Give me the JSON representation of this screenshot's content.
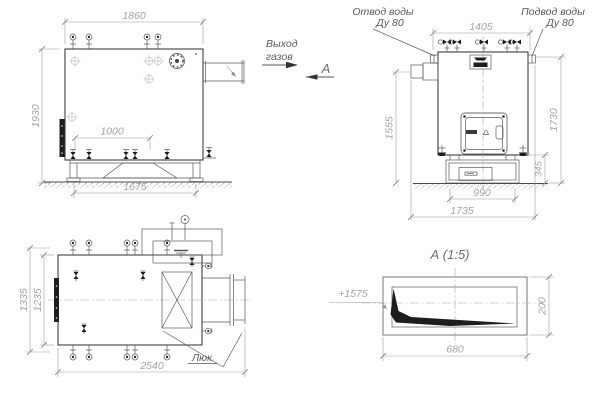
{
  "drawing_type": "boiler-assembly-drawing",
  "colors": {
    "background": "#ffffff",
    "object_line": "#3e3e3e",
    "thin_line": "#5a5a5a",
    "dimension_line": "#9c9c9c",
    "dimension_text": "#a4a4a4",
    "label_text": "#595959",
    "solid_fill": "#1d1d1d"
  },
  "annotations": {
    "gas_exit_line1": "Выход",
    "gas_exit_line2": "газов",
    "section_label": "А",
    "water_outlet_line1": "Отвод воды",
    "water_outlet_line2": "Ду 80",
    "water_inlet_line1": "Подвод воды",
    "water_inlet_line2": "Ду 80",
    "hatch_label": "Люк",
    "detail_title": "А (1:5)"
  },
  "dimensions": {
    "side_view": {
      "overall_width": "1860",
      "overall_height": "1930",
      "connection_spacing": "1000",
      "base_width": "1675"
    },
    "front_view": {
      "top_connections_width": "1405",
      "duct_axis_height": "1555",
      "overall_height": "1730",
      "base_height": "345",
      "base_width": "990",
      "overall_width": "1735"
    },
    "plan_view": {
      "overall_depth": "1335",
      "body_depth": "1235",
      "overall_length": "2540"
    },
    "detail_a": {
      "elevation_mark": "+1575",
      "height": "200",
      "length": "680"
    }
  }
}
